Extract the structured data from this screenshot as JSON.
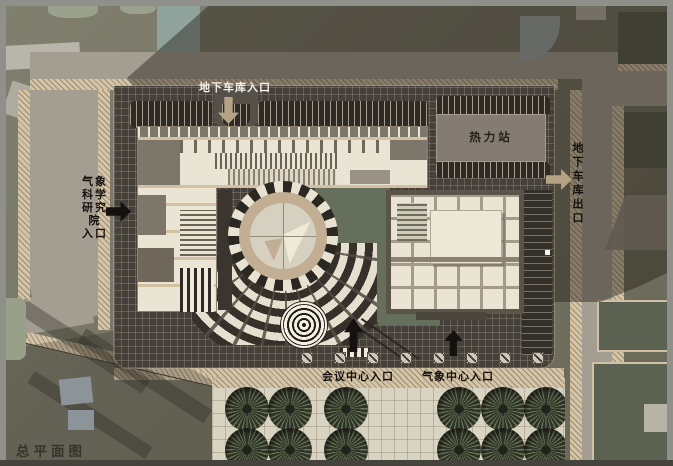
{
  "title": {
    "text": "总平面图"
  },
  "labels": {
    "garage_entrance": "地下车库入口",
    "heating_station": "热力站",
    "garage_exit": "地下车库出口",
    "institute_entrance": "气象\n科学\n研究\n院\n入口",
    "conference_entrance": "会议中心入口",
    "meteorology_entrance": "气象中心入口"
  },
  "palette": {
    "background_olive": "#7b7a6c",
    "road": "#a39d92",
    "sidewalk_hatch": "#d4c5a9",
    "site_paving": "#45403a",
    "building_roof": "#e9e4d3",
    "heating_station_roof": "#847c72",
    "tree_green": "#6f7a57",
    "context_green": "#565a4a",
    "arrow_tan": "#b5a383",
    "arrow_black": "#14110e",
    "label_white": "#f4f1e8",
    "shadow": "rgba(36,29,23,0.44)"
  }
}
